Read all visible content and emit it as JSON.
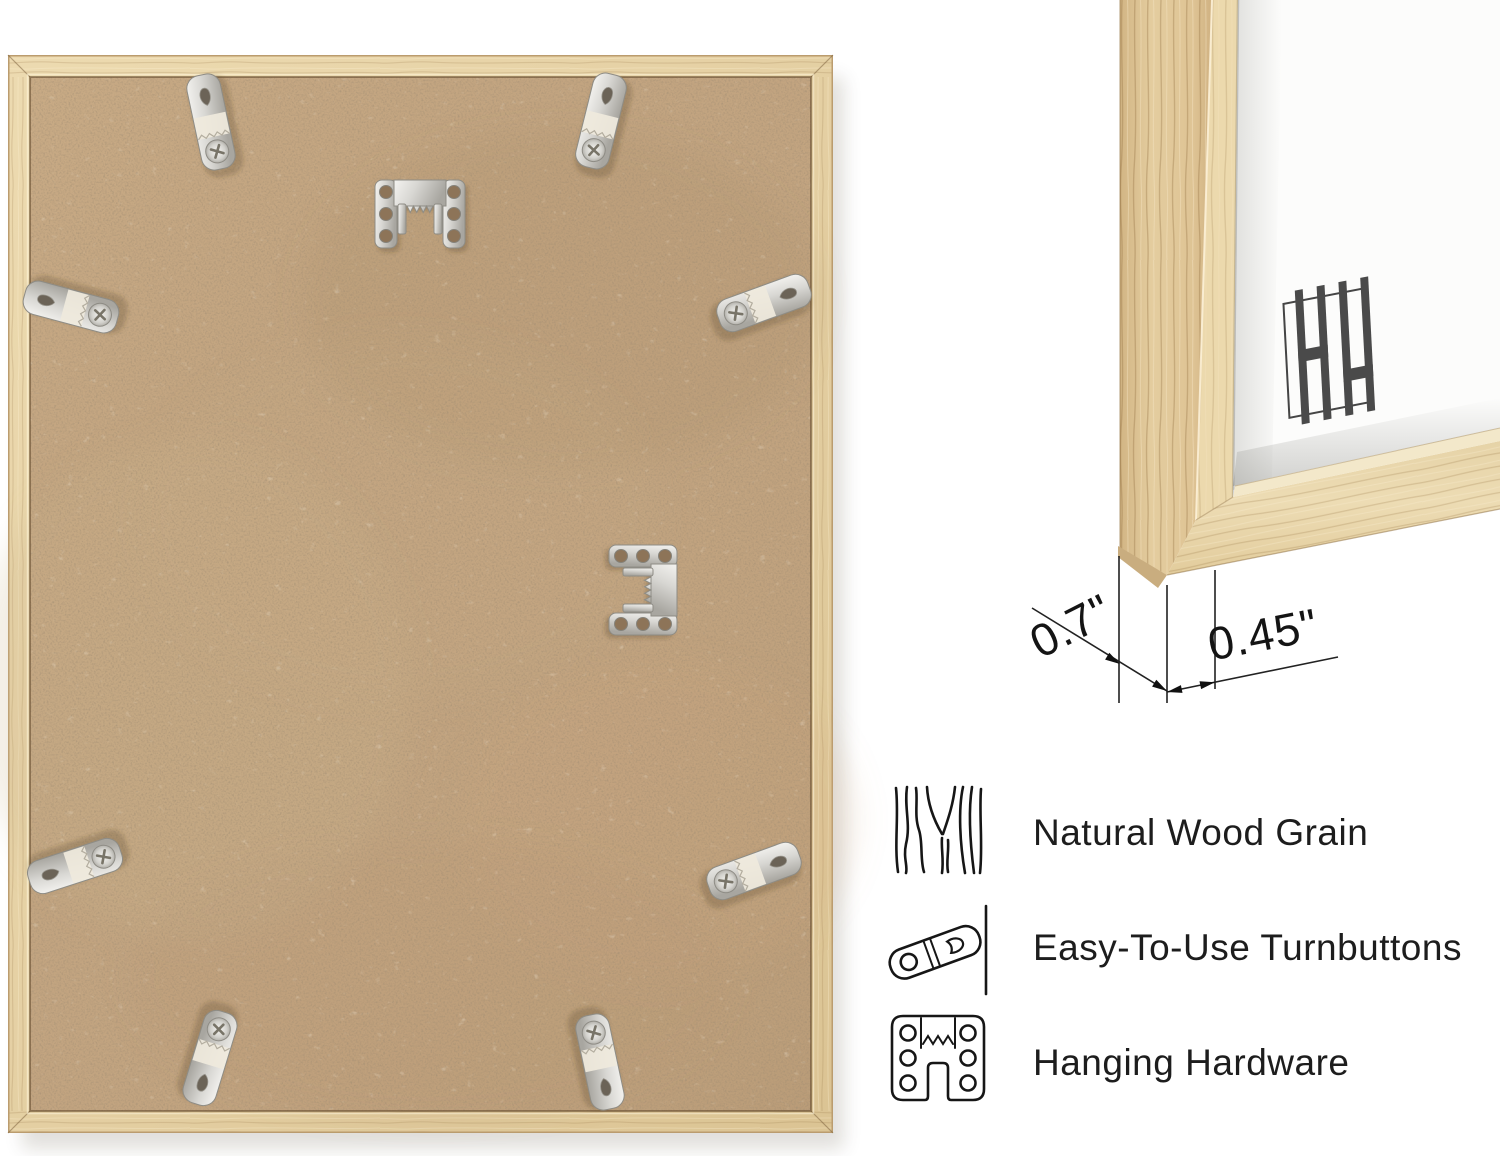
{
  "product": {
    "view_left": "frame-back-with-hardware",
    "view_right": "frame-corner-closeup"
  },
  "dimensions": {
    "depth": "0.7\"",
    "face_width": "0.45\""
  },
  "features": [
    {
      "icon": "wood-grain-icon",
      "label": "Natural Wood Grain"
    },
    {
      "icon": "turnbutton-icon",
      "label": "Easy-To-Use Turnbuttons"
    },
    {
      "icon": "hanging-hardware-icon",
      "label": "Hanging Hardware"
    }
  ],
  "colors": {
    "wood": "#e6d2a6",
    "wood_shadowed": "#d3b888",
    "mdf": "#c2a480",
    "metal": "#d8d7d3",
    "mat": "#fcfcfb",
    "logo": "#4a4a4a",
    "ink": "#1a1a1a"
  }
}
